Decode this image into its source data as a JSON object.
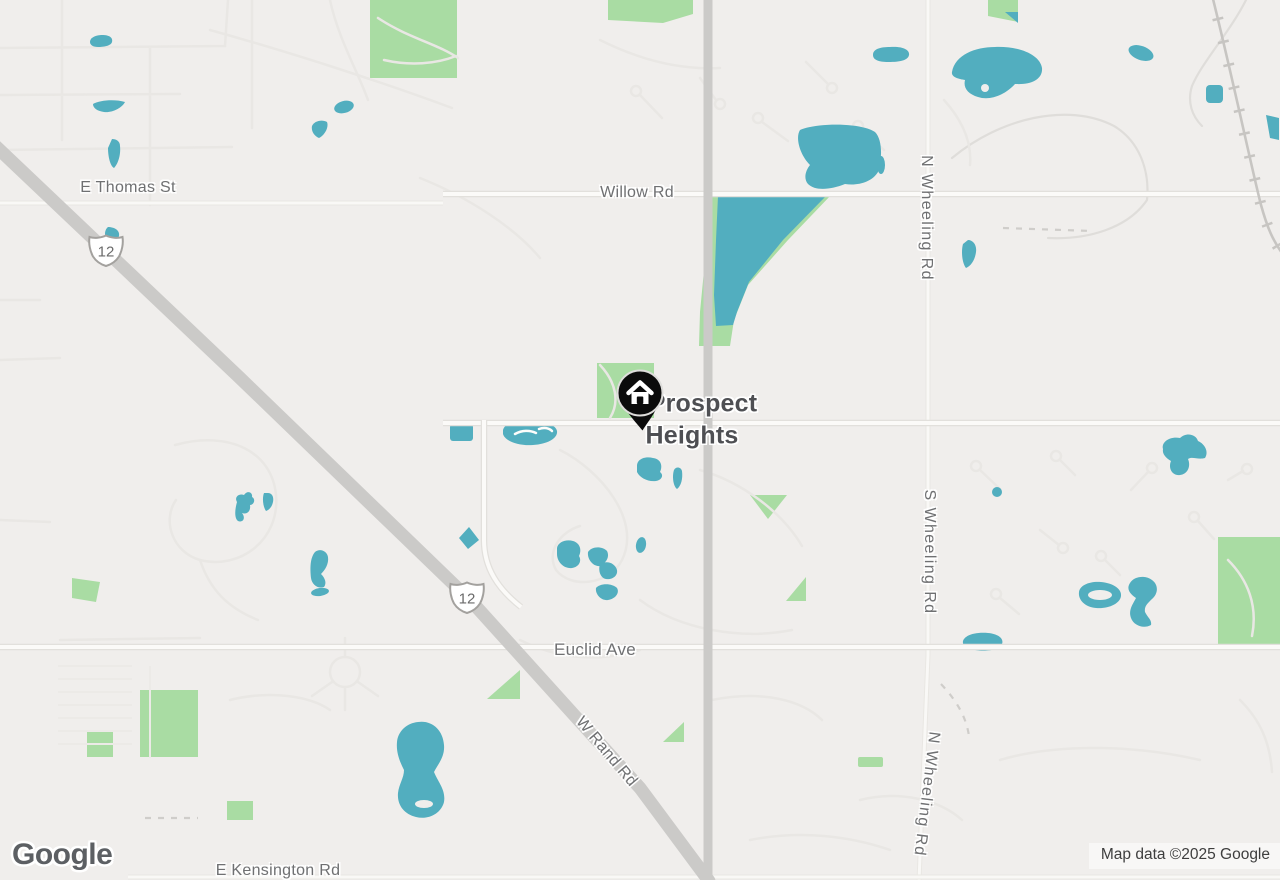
{
  "map": {
    "attribution": "Map data ©2025 Google",
    "watermark": "Google",
    "place_label": {
      "line1": "Prospect",
      "line2": "Heights"
    },
    "marker": {
      "icon": "home"
    },
    "road_labels": [
      {
        "id": "e-thomas-st",
        "text": "E Thomas St"
      },
      {
        "id": "willow-rd",
        "text": "Willow Rd"
      },
      {
        "id": "n-wheeling-rd-top",
        "text": "N Wheeling Rd"
      },
      {
        "id": "s-wheeling-rd",
        "text": "S Wheeling Rd"
      },
      {
        "id": "n-wheeling-rd-bottom",
        "text": "N Wheeling Rd"
      },
      {
        "id": "euclid-ave",
        "text": "Euclid Ave"
      },
      {
        "id": "w-rand-rd",
        "text": "W Rand Rd"
      },
      {
        "id": "e-kensington-rd",
        "text": "E Kensington Rd"
      }
    ],
    "route_shields": [
      {
        "label": "12"
      },
      {
        "label": "12"
      }
    ],
    "colors": {
      "background": "#f0eeec",
      "water": "#52aebf",
      "park": "#a9dca3",
      "road_major": "#cbcac8",
      "road_minor_fill": "#fbfaf8",
      "road_minor_casing": "#e2e0dc",
      "road_faint": "#e9e7e4",
      "railroad": "#c7c5c2",
      "label_road": "#6f7072",
      "label_city": "#4e4f53",
      "marker": "#0b0b0b",
      "watermark": "#5c5f63",
      "attribution_text": "#3e3e3e"
    }
  }
}
